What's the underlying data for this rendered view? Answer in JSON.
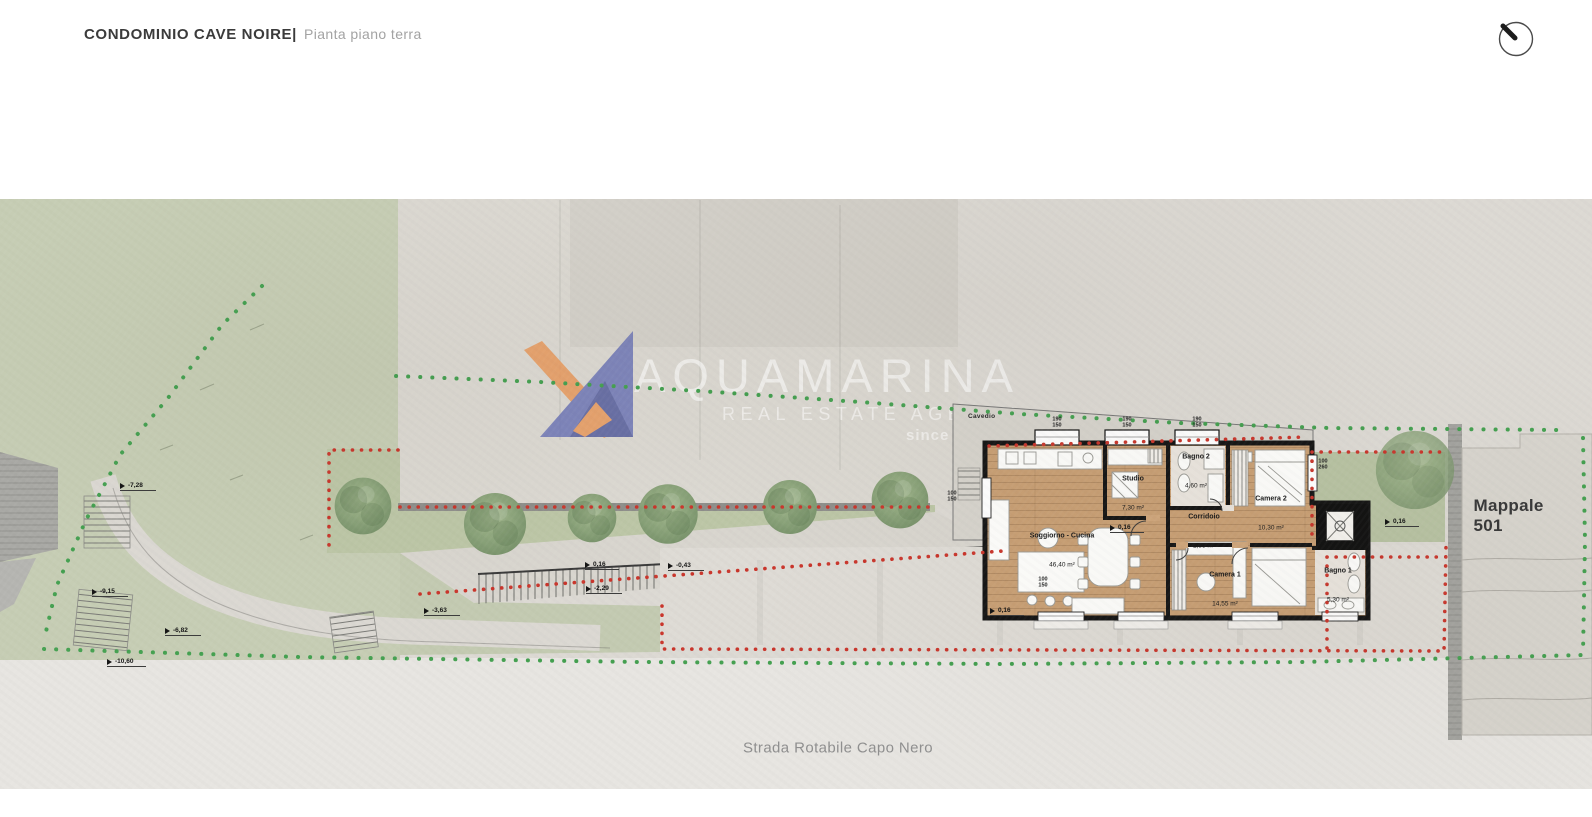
{
  "header": {
    "title": "CONDOMINIO CAVE NOIRE|",
    "subtitle": "Pianta piano terra"
  },
  "watermark": {
    "brand": "AQUAMARINA",
    "tagline": "REAL ESTATE AGENCY",
    "since": "since 2003"
  },
  "plan": {
    "area_labels": {
      "cavedio": "Cavedio",
      "parcel": "Mappale 501",
      "road": "Strada Rotabile Capo Nero"
    },
    "rooms": [
      {
        "name": "Soggiorno - Cucina",
        "area": "46,40 m²"
      },
      {
        "name": "Studio",
        "area": "7,30 m²"
      },
      {
        "name": "Bagno 2",
        "area": "4,60 m²"
      },
      {
        "name": "Camera 2",
        "area": "10,30 m²"
      },
      {
        "name": "Corridoio",
        "area": "2,85 m²"
      },
      {
        "name": "Camera 1",
        "area": "14,55 m²"
      },
      {
        "name": "Bagno 1",
        "area": "5,30 m²"
      }
    ],
    "elevations": [
      "-7,28",
      "-9,15",
      "-6,82",
      "-10,60",
      "-3,63",
      "0,16",
      "-0,43",
      "-2,29",
      "0,16",
      "0,16",
      "0,16"
    ],
    "window_dims": [
      "100\n150",
      "190\n150",
      "190\n150",
      "190\n150",
      "100\n260",
      "100\n150"
    ]
  },
  "colors": {
    "boundary_green": "#44a050",
    "boundary_red": "#c9352b",
    "logo_blue": "#6d76b6",
    "logo_blue_dark": "#545d9e",
    "logo_orange": "#e9995c",
    "wood": "#c89f74",
    "hillside": "#c6cdb4"
  }
}
